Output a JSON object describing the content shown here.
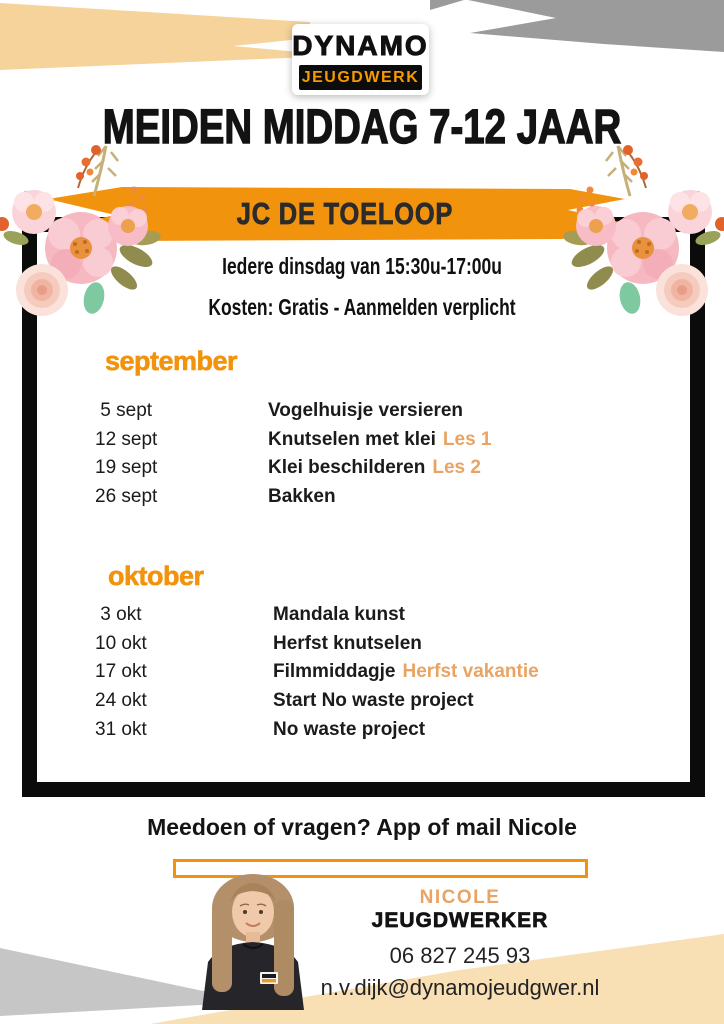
{
  "logo": {
    "name": "DYNAMO",
    "subtitle": "JEUGDWERK"
  },
  "header": {
    "title": "MEIDEN MIDDAG 7-12 JAAR"
  },
  "banner": {
    "location": "JC DE TOELOOP"
  },
  "info": {
    "schedule_line": "Iedere dinsdag van 15:30u-17:00u",
    "cost_line": "Kosten: Gratis - Aanmelden verplicht"
  },
  "program": {
    "september": {
      "title": "september",
      "rows": [
        {
          "date": " 5 sept",
          "activity": "Vogelhuisje versieren",
          "note": ""
        },
        {
          "date": "12 sept",
          "activity": "Knutselen met klei",
          "note": "Les 1"
        },
        {
          "date": "19 sept",
          "activity": "Klei beschilderen",
          "note": "Les 2"
        },
        {
          "date": "26 sept",
          "activity": "Bakken",
          "note": ""
        }
      ]
    },
    "oktober": {
      "title": "oktober",
      "rows": [
        {
          "date": " 3 okt",
          "activity": "Mandala kunst",
          "note": ""
        },
        {
          "date": "10 okt",
          "activity": "Herfst knutselen",
          "note": ""
        },
        {
          "date": "17 okt",
          "activity": "Filmmiddagje",
          "note": "Herfst vakantie"
        },
        {
          "date": "24 okt",
          "activity": "Start No waste project",
          "note": ""
        },
        {
          "date": "31 okt",
          "activity": "No waste project",
          "note": ""
        }
      ]
    }
  },
  "footer": {
    "cta": "Meedoen of vragen? App of mail Nicole"
  },
  "contact": {
    "name": "NICOLE",
    "role": "JEUGDWERKER",
    "phone": "06 827 245 93",
    "email": "n.v.dijk@dynamojeudgwer.nl"
  },
  "colors": {
    "orange": "#F2930D",
    "logo_orange": "#F59A00",
    "light_orange": "#E9A464",
    "beige": "#F6D39B",
    "beige_bottom": "#F8DFB4",
    "gray_top": "#9B9B9B",
    "gray_bottom": "#C6C6C6",
    "black": "#0B0B0B"
  }
}
